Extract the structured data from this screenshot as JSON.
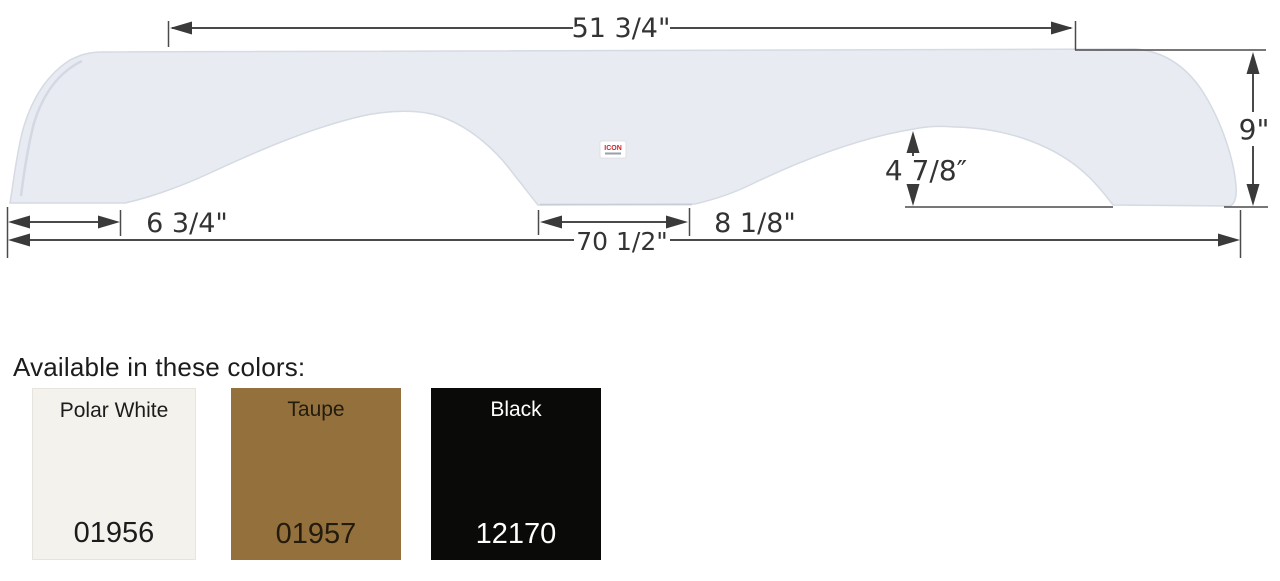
{
  "page": {
    "background": "#ffffff"
  },
  "diagram": {
    "part_color": "#e8ebf2",
    "part_edge_color": "#d5dae3",
    "line_color": "#4a4a4a",
    "dimensions": {
      "top_width": "51 3/4\"",
      "right_height": "9\"",
      "arch_depth": "4 7/8″",
      "left_end_width": "6 3/4\"",
      "center_width": "8 1/8\"",
      "overall_width": "70 1/2\""
    },
    "logo": {
      "brand": "ICON"
    }
  },
  "colors_section": {
    "heading": "Available in these colors:",
    "swatches": [
      {
        "name": "Polar White",
        "code": "01956",
        "bg": "#f4f2ed",
        "fg": "#1c1c1c"
      },
      {
        "name": "Taupe",
        "code": "01957",
        "bg": "#94713c",
        "fg": "#221b0e"
      },
      {
        "name": "Black",
        "code": "12170",
        "bg": "#0a0a09",
        "fg": "#ffffff"
      }
    ]
  }
}
